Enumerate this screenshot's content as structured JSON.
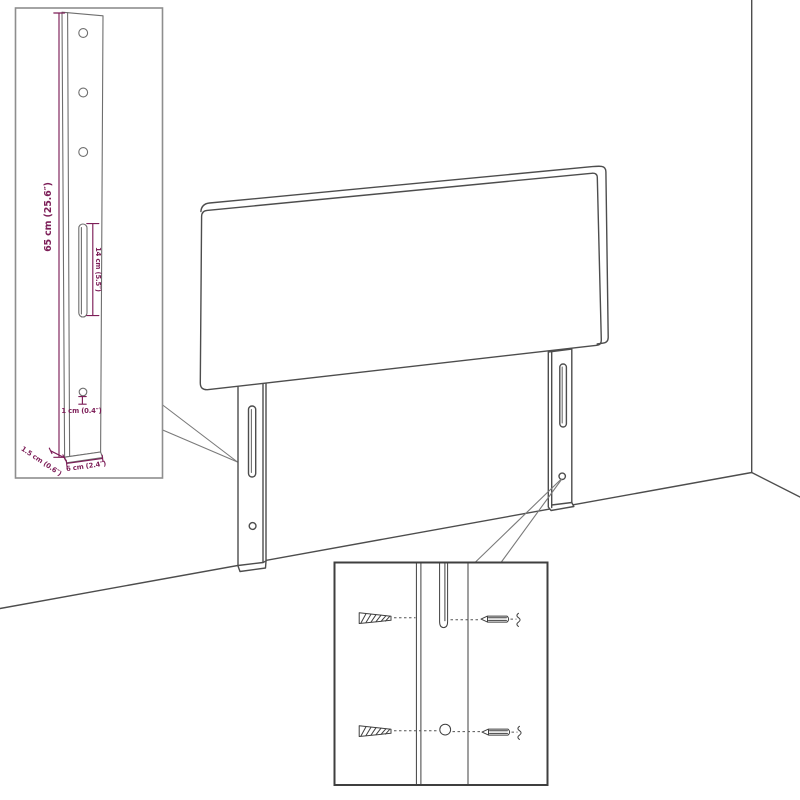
{
  "colors": {
    "background": "#ffffff",
    "artwork_line": "#4d4d4d",
    "dimension_text": "#7d1e58",
    "inset_border_light": "#8e8e8e",
    "inset_border_dark": "#3f3f3f"
  },
  "leg_detail_inset": {
    "dim_leg_height": "65 cm (25.6″)",
    "dim_slot_length": "14 cm (5.5″)",
    "dim_hole": "1 cm (0.4″)",
    "dim_thickness": "1.5 cm (0.6″)",
    "dim_width": "6 cm (2.4″)"
  }
}
